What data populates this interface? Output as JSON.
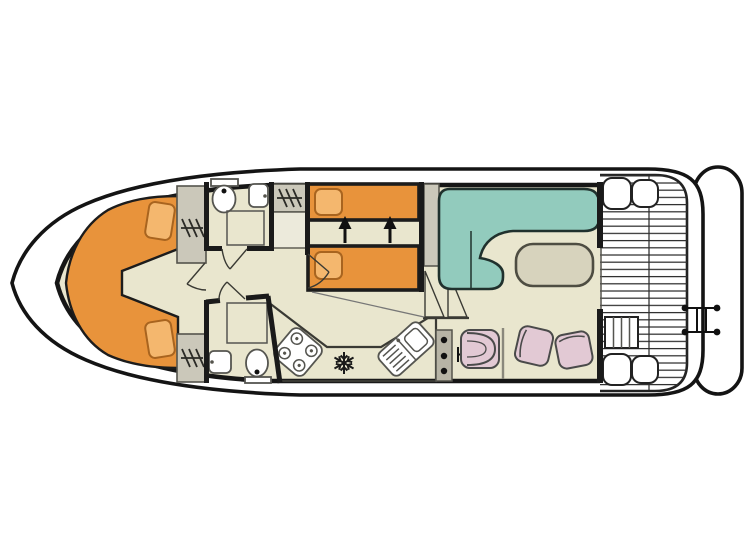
{
  "title": "Houseboat interior floor plan (top view)",
  "colors": {
    "background": "#ffffff",
    "hull": "#ffffff",
    "outline": "#141414",
    "floor": "#e9e6ce",
    "wall": "#1a1a1a",
    "bed_orange": "#e8933b",
    "pillow_orange": "#f4b76e",
    "sofa_teal": "#92cbbd",
    "table_fill": "#d7d3bd",
    "chair_pink": "#e2c9d4",
    "cabinet_gray": "#cbc8ba",
    "cabinet_light": "#eceadb",
    "counter": "#c9c6b4",
    "console": "#b7b4a5",
    "fixture_white": "#ffffff",
    "shower_bg": "#f4f2e6",
    "shower_line": "#90908a",
    "slat_line": "#2e2e2e",
    "black_detail": "#111111"
  },
  "icons": {
    "wardrobe": "hanging-rail-with-hangers",
    "toilet": "oval-bowl-with-cistern",
    "sink": "rounded-basin",
    "shower": "grid-tray",
    "stove": "four-burner-hob",
    "fridge": "snowflake",
    "galley_sink": "basin-with-drainer",
    "helm_console": "panel-with-three-dots",
    "throttle": "t-lever",
    "stairs": "double-triangle-steps",
    "deck_steps": "slatted-step-box",
    "swim_ladder": "two-rung-ladder",
    "berth_arrows": "twin-beds-slide-together",
    "door": "quarter-swing-arc"
  },
  "areas": {
    "bow_cabin": "v-berth-double-cabin",
    "bathroom_fore": "wc-shower-fore",
    "bathroom_aft": "wc-shower-aft",
    "twin_cabin": "twin-berth-cabin",
    "saloon": "saloon-with-l-sofa-and-table",
    "galley": "galley-counter",
    "helm": "inside-steering-position",
    "aft_deck": "slatted-rear-deck",
    "swim_platform": "stern-platform-with-ladder"
  }
}
